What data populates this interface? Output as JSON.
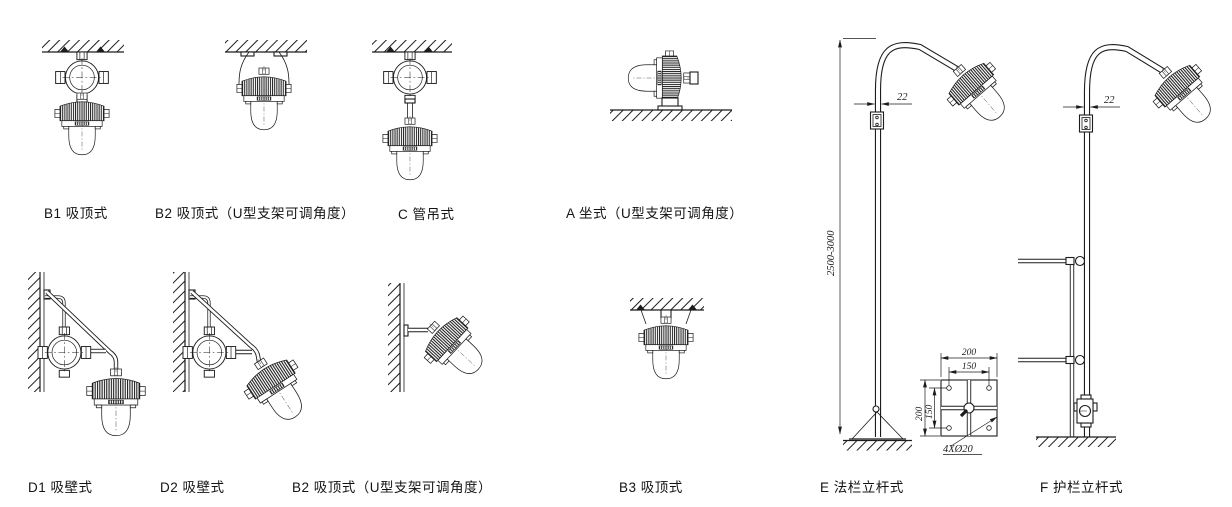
{
  "canvas": {
    "width": 1232,
    "height": 507,
    "background": "#ffffff",
    "ink": "#1c1c1c"
  },
  "labels": {
    "b1": "B1 吸顶式",
    "b2_top": "B2 吸顶式（U型支架可调角度）",
    "c": "C 管吊式",
    "a": "A 坐式（U型支架可调角度）",
    "d1": "D1 吸壁式",
    "d2": "D2 吸壁式",
    "b2_bottom": "B2 吸顶式（U型支架可调角度）",
    "b3": "B3 吸顶式",
    "e": "E 法栏立杆式",
    "f": "F 护栏立杆式"
  },
  "dimensions": {
    "pole_tube_width_e": "22",
    "pole_tube_width_f": "22",
    "pole_height_range": "2500-3000",
    "base_plate_width": "200",
    "base_plate_hole_spacing_h": "150",
    "base_plate_height": "200",
    "base_plate_hole_spacing_v": "150",
    "base_plate_holes": "4XØ20"
  }
}
